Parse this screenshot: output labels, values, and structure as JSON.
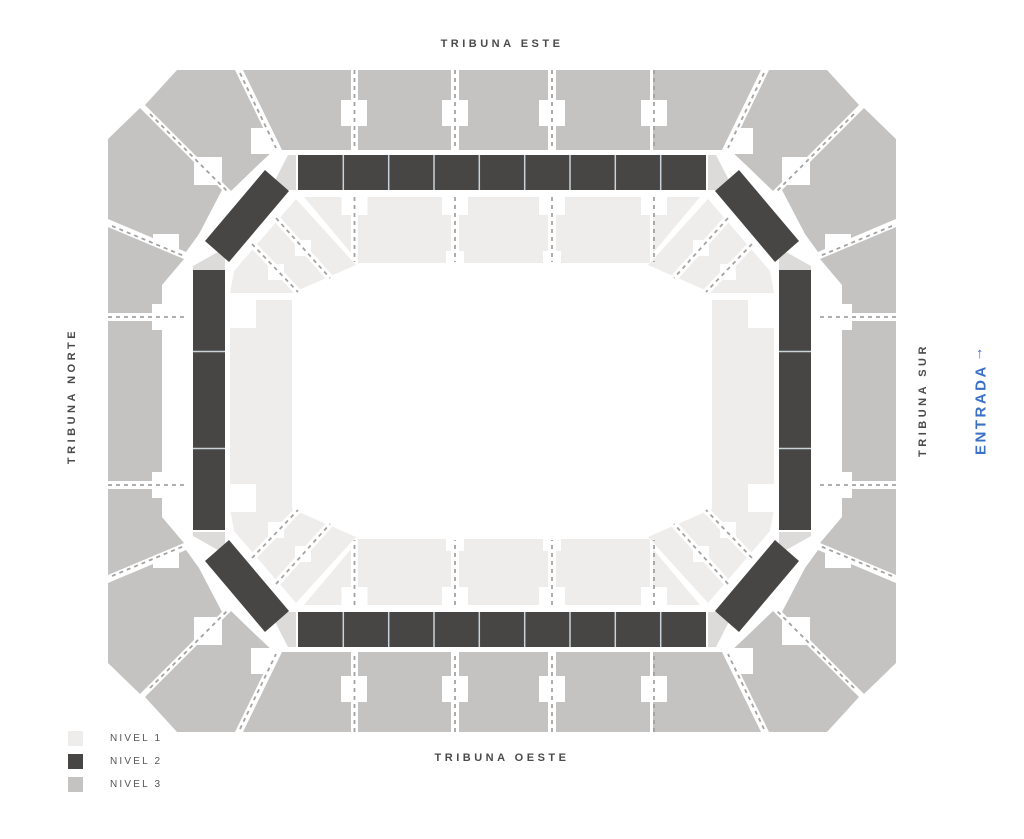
{
  "labels": {
    "top": "TRIBUNA ESTE",
    "bottom": "TRIBUNA OESTE",
    "left": "TRIBUNA NORTE",
    "right": "TRIBUNA SUR",
    "entrance": "ENTRADA",
    "entrance_arrow": "↑"
  },
  "legend": [
    {
      "label": "NIVEL 1",
      "color": "#efedec"
    },
    {
      "label": "NIVEL 2",
      "color": "#474645"
    },
    {
      "label": "NIVEL 3",
      "color": "#c4c3c2"
    }
  ],
  "colors": {
    "nivel1": "#efedec",
    "nivel2": "#474645",
    "nivel3": "#c4c3c2",
    "connector": "#dcdbd9",
    "separator": "#c9d3da",
    "dash": "#a3a3a3",
    "entrance_blue": "#3a70c6",
    "label_gray": "#4a4a4a"
  }
}
